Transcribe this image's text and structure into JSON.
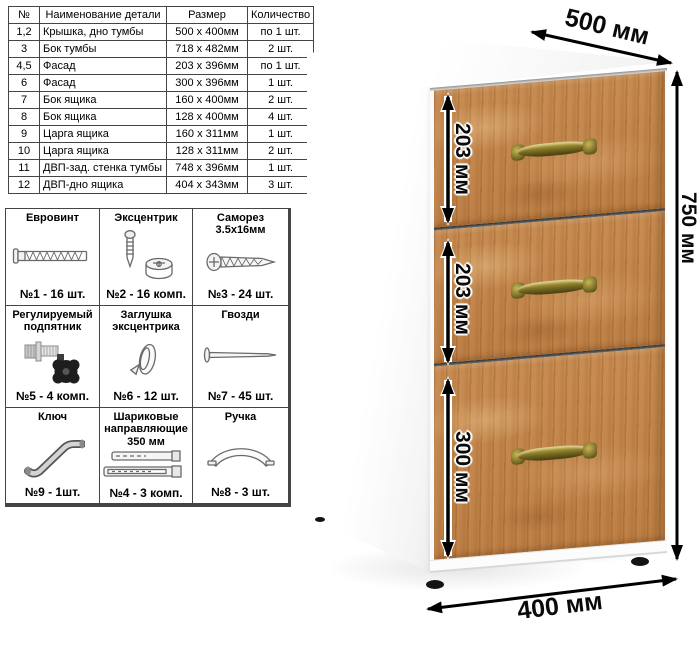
{
  "parts_table": {
    "headers": [
      "№",
      "Наименование детали",
      "Размер",
      "Количество"
    ],
    "rows": [
      [
        "1,2",
        "Крышка, дно тумбы",
        "500 х 400мм",
        "по 1 шт."
      ],
      [
        "3",
        "Бок тумбы",
        "718 х 482мм",
        "2 шт."
      ],
      [
        "4,5",
        "Фасад",
        "203 х 396мм",
        "по 1 шт."
      ],
      [
        "6",
        "Фасад",
        "300 х 396мм",
        "1 шт."
      ],
      [
        "7",
        "Бок ящика",
        "160 х 400мм",
        "2 шт."
      ],
      [
        "8",
        "Бок ящика",
        "128 х 400мм",
        "4 шт."
      ],
      [
        "9",
        "Царга ящика",
        "160 х 311мм",
        "1 шт."
      ],
      [
        "10",
        "Царга ящика",
        "128 х 311мм",
        "2 шт."
      ],
      [
        "11",
        "ДВП-зад. стенка тумбы",
        "748 х 396мм",
        "1 шт."
      ],
      [
        "12",
        "ДВП-дно ящика",
        "404 х 343мм",
        "3 шт."
      ]
    ]
  },
  "hardware_table": {
    "cells": [
      {
        "title": "Евровинт",
        "count": "№1 - 16 шт.",
        "icon": "euro-screw-icon"
      },
      {
        "title": "Эксцентрик",
        "count": "№2 - 16 комп.",
        "icon": "eccentric-cam-icon"
      },
      {
        "title": "Саморез 3.5х16мм",
        "count": "№3 - 24 шт.",
        "icon": "self-tapping-screw-icon"
      },
      {
        "title": "Регулируемый подпятник",
        "count": "№5 - 4 комп.",
        "icon": "adjustable-foot-icon"
      },
      {
        "title": "Заглушка эксцентрика",
        "count": "№6 - 12 шт.",
        "icon": "cam-cap-icon"
      },
      {
        "title": "Гвозди",
        "count": "№7 - 45 шт.",
        "icon": "nail-icon"
      },
      {
        "title": "Ключ",
        "count": "№9 - 1шт.",
        "icon": "hex-key-icon"
      },
      {
        "title": "Шариковые направляющие 350 мм",
        "count": "№4 - 3 комп.",
        "icon": "ball-bearing-slides-icon"
      },
      {
        "title": "Ручка",
        "count": "№8 - 3 шт.",
        "icon": "bow-handle-icon"
      }
    ]
  },
  "dimensions": {
    "depth": "500 мм",
    "height": "750 мм",
    "width": "400 мм",
    "drawer_top": "203 мм",
    "drawer_middle": "203 мм",
    "drawer_bottom": "300 мм"
  },
  "colors": {
    "wood": "#c08550",
    "handle_brass": "#8a7b2c",
    "cabinet_body": "#ffffff",
    "dimension_text": "#000000"
  }
}
